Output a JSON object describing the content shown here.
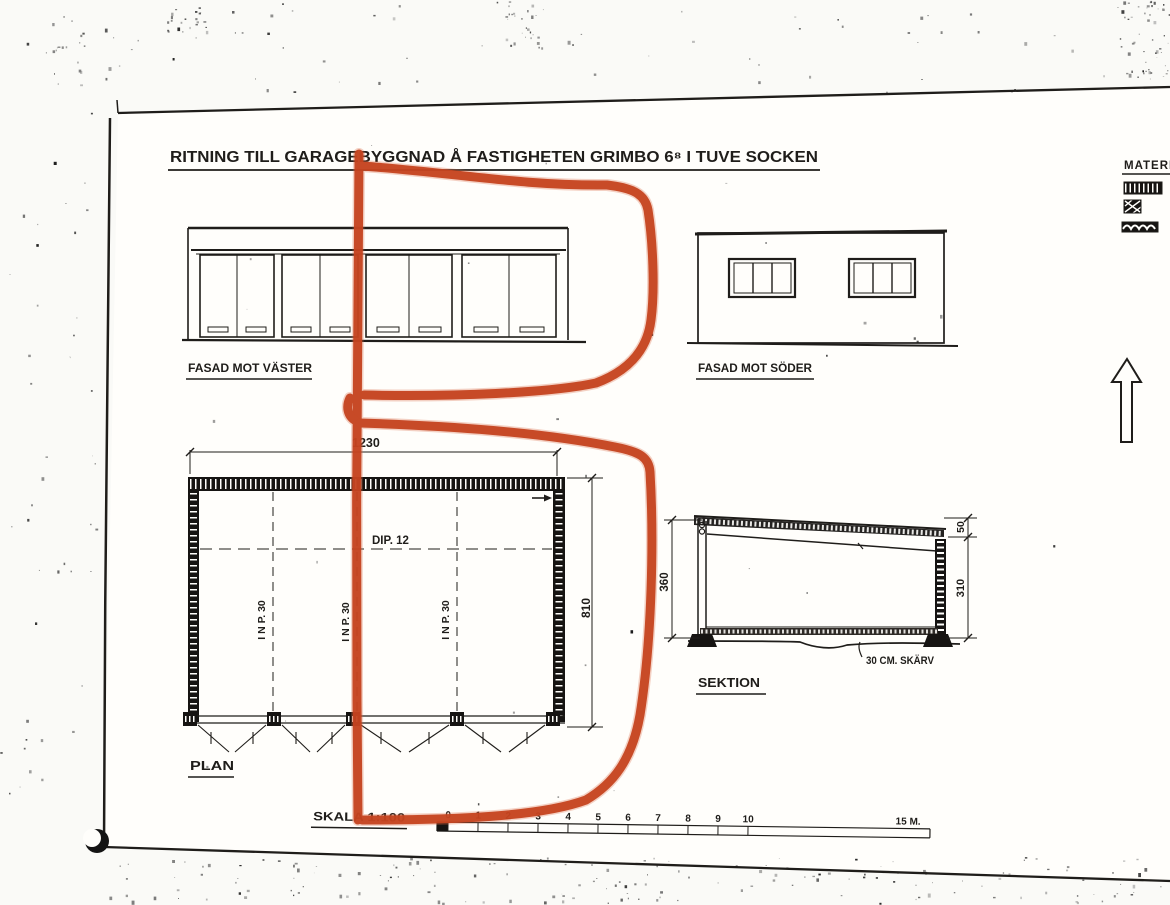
{
  "sheet": {
    "title": "RITNING TILL GARAGEBYGGNAD Å FASTIGHETEN GRIMBO 6⁸ I TUVE SOCKEN"
  },
  "drawings": {
    "facade_west": {
      "label": "FASAD MOT VÄSTER"
    },
    "facade_south": {
      "label": "FASAD MOT SÖDER"
    },
    "plan": {
      "label": "PLAN",
      "dim_width": "1230",
      "dim_depth": "810",
      "beam_label": "DIP. 12",
      "column_labels": [
        "I N P. 30",
        "I N P. 30",
        "I N P. 30"
      ]
    },
    "section": {
      "label": "SEKTION",
      "dim_height": "360",
      "dim_parapet": "50",
      "dim_clear": "310",
      "note": "30 CM. SKÄRV"
    }
  },
  "scale_bar": {
    "label": "SKALA 1:100",
    "ticks": [
      "0",
      "1",
      "2",
      "3",
      "4",
      "5",
      "6",
      "7",
      "8",
      "9",
      "10"
    ],
    "end_label": "15 M."
  },
  "legend": {
    "title": "MATERIAL"
  },
  "annotation": {
    "color": "#c5431f",
    "shape": "hand-drawn red marker loops"
  },
  "ink_color": "#1f1d1a"
}
